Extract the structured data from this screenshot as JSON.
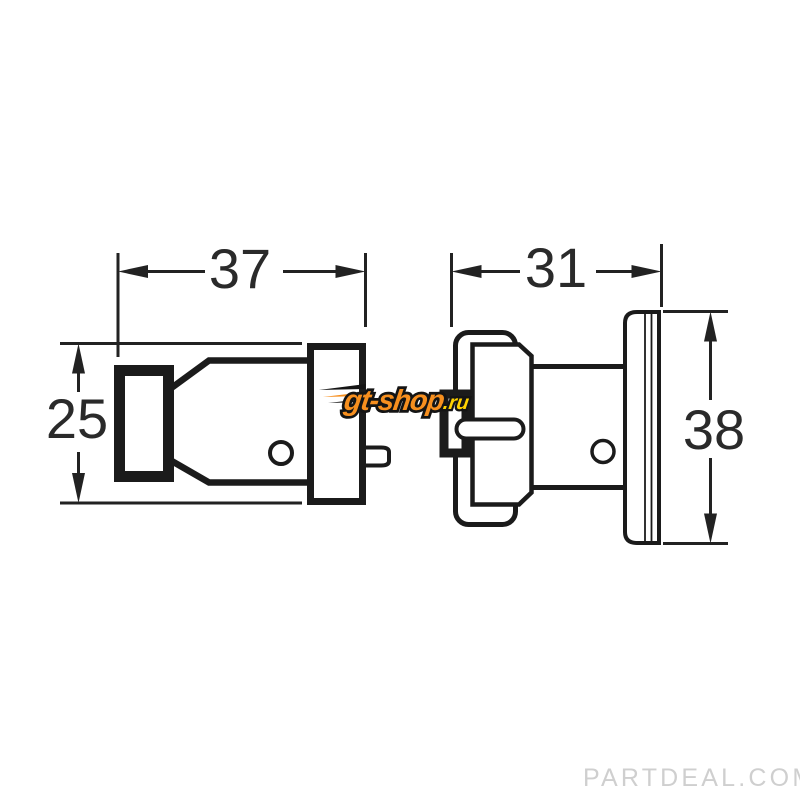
{
  "diagram": {
    "title_hint": "connector-plug-and-socket-dimension-drawing",
    "dimensions": {
      "plug_length": "37",
      "plug_flange_height": "25",
      "socket_length": "31",
      "socket_flange_height": "38"
    },
    "watermark": {
      "brand": "gt-shop",
      "tld": ".ru"
    },
    "footer_watermark": "PARTDEAL.COM",
    "colors": {
      "line": "#1b1b1b",
      "dimension_line": "#222222",
      "dimension_text": "#2a2a2a",
      "watermark_orange": "#f78f1e",
      "watermark_yellow": "#ffd200",
      "footer_gray": "#cfcfcf",
      "background": "#ffffff"
    }
  }
}
